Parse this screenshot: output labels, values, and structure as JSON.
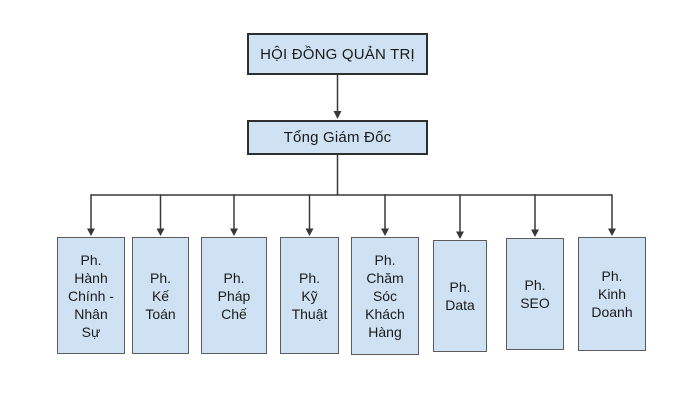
{
  "org": {
    "root": {
      "label": "HỘI ĐỒNG QUẢN TRỊ"
    },
    "director": {
      "label": "Tổng Giám Đốc"
    },
    "departments": [
      {
        "label": "Ph. Hành Chính - Nhân Sự"
      },
      {
        "label": "Ph. Kế Toán"
      },
      {
        "label": "Ph. Pháp Chế"
      },
      {
        "label": "Ph. Kỹ Thuật"
      },
      {
        "label": "Ph. Chăm Sóc Khách Hàng"
      },
      {
        "label": "Ph. Data"
      },
      {
        "label": "Ph. SEO"
      },
      {
        "label": "Ph. Kinh Doanh"
      }
    ]
  },
  "colors": {
    "node_fill": "#cfe2f3",
    "node_border_dark": "#2f2f2f",
    "node_border_light": "#5b5b5b",
    "connector": "#383838",
    "text": "#1a1a1a",
    "background": "#ffffff"
  }
}
